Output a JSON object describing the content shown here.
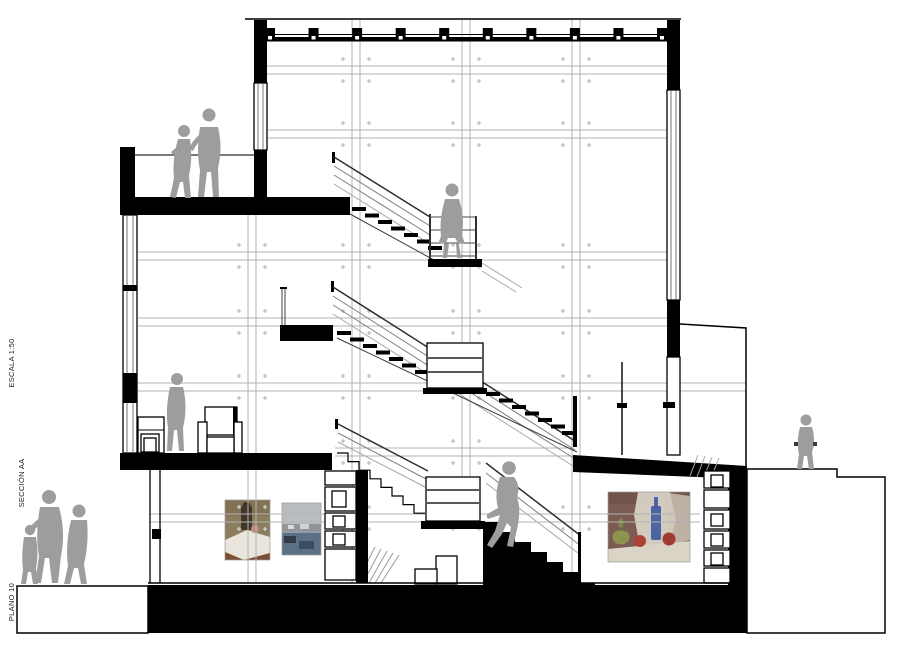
{
  "annotations": {
    "escala": "ESCALA 1:50",
    "seccion": "SECCIÓN AA",
    "plano": "PLANO 10"
  },
  "drawing": {
    "type": "architectural-building-section",
    "ink_color": "#000000",
    "figure_color": "#9d9d9d",
    "grid": {
      "color": "#b3b3b3",
      "marker_color": "#c6c6c6",
      "pair_gap": 8,
      "v_pairs": [
        {
          "x": 248,
          "y1": 215,
          "y2": 583
        },
        {
          "x": 352,
          "y1": 19,
          "y2": 583
        },
        {
          "x": 462,
          "y1": 19,
          "y2": 524
        },
        {
          "x": 572,
          "y1": 19,
          "y2": 583
        }
      ],
      "h_pairs": [
        {
          "y": 66,
          "x1": 267,
          "x2": 667
        },
        {
          "y": 130,
          "x1": 267,
          "x2": 667
        },
        {
          "y": 252,
          "x1": 138,
          "x2": 667
        },
        {
          "y": 318,
          "x1": 138,
          "x2": 667
        },
        {
          "y": 383,
          "x1": 138,
          "x2": 746
        },
        {
          "y": 448,
          "x1": 335,
          "x2": 573
        },
        {
          "y": 514,
          "x1": 150,
          "x2": 700
        }
      ]
    },
    "figures": [
      {
        "id": "couple-on-roof-terrace",
        "pose": "two adults talking"
      },
      {
        "id": "person-on-stair-landing",
        "pose": "walking down"
      },
      {
        "id": "person-first-floor",
        "pose": "standing by chair"
      },
      {
        "id": "person-climbing-stair",
        "pose": "climbing"
      },
      {
        "id": "group-outside-left",
        "pose": "three people walking"
      },
      {
        "id": "child-outside-right",
        "pose": "standing"
      }
    ],
    "paintings": [
      {
        "id": "still-life-with-vase",
        "palette": [
          "#8b7d5e",
          "#e9e5da",
          "#42362b",
          "#c08a84"
        ]
      },
      {
        "id": "harbour-scene",
        "palette": [
          "#b8bdc0",
          "#5a7084",
          "#2f3c47"
        ]
      },
      {
        "id": "still-life-with-bottle",
        "palette": [
          "#7b5b52",
          "#ddd7cb",
          "#3c5a9e",
          "#ad4136",
          "#8e9450"
        ]
      }
    ]
  }
}
